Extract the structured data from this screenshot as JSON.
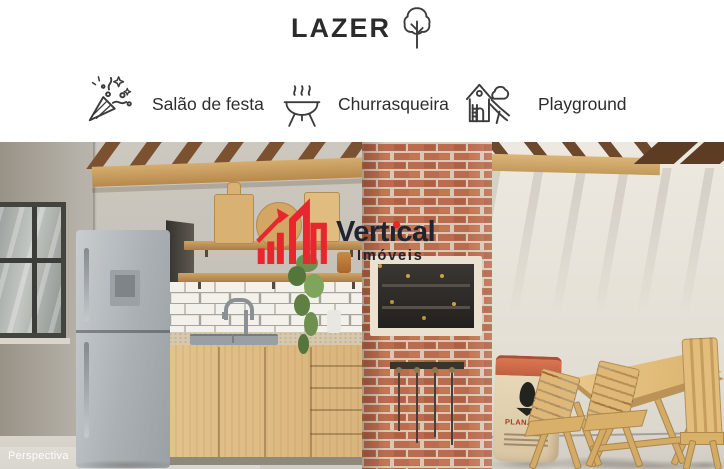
{
  "header": {
    "title": "LAZER",
    "icon": "tree-icon"
  },
  "amenities": [
    {
      "icon": "party-popper-icon",
      "label": "Salão de festa"
    },
    {
      "icon": "barbecue-icon",
      "label": "Churrasqueira"
    },
    {
      "icon": "playground-icon",
      "label": "Playground"
    }
  ],
  "photo": {
    "caption": "Perspectiva",
    "charcoal_bag": {
      "label": "PLANALTO"
    },
    "watermark": {
      "brand": "Vertical",
      "brand_pre": "Vert",
      "brand_i": "ı",
      "brand_post": "cal",
      "subtitle": "Imóveis",
      "logo": "vertical-imoveis-buildings-logo",
      "accent_color": "#e8262d",
      "text_color": "#21242e"
    }
  },
  "style": {
    "icon_stroke": "#3b3b3b",
    "title_color": "#2b2b2b",
    "brick_color": "#bc6c4e",
    "wood_color": "#d2a96b"
  }
}
